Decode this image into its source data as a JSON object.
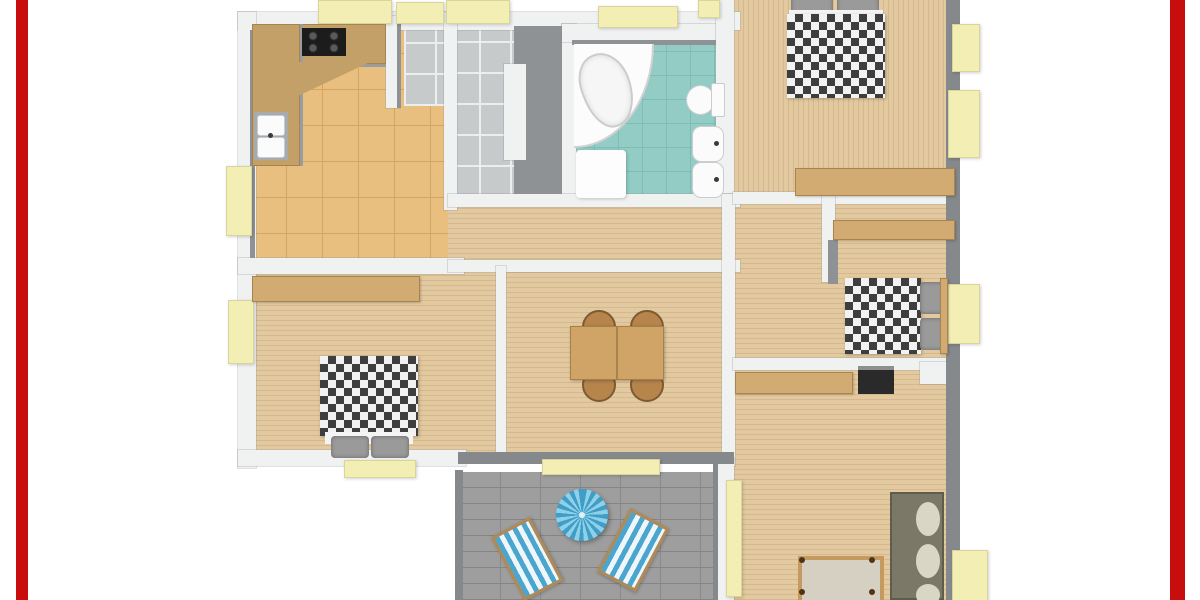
{
  "palette": {
    "page_bg": "#ffffff",
    "frame_red": "#c80d0d",
    "wall_light": "#f0f1f1",
    "wall_mid": "#8f9295",
    "wall_dark": "#85898c",
    "window_sill": "#f3efb4",
    "sill_edge": "#d8d49c",
    "kitchen_tile": "#e8bf7e",
    "kitchen_tile_line": "#d6a65f",
    "counter_wood": "#c4a069",
    "cooktop_black": "#1c1c1c",
    "entry_tile": "#c7cacb",
    "entry_tile_line": "#eceeee",
    "bath_tile": "#92ccc5",
    "bath_tile_line": "#7ebdb6",
    "fixture_white": "#fbfbfb",
    "wood_floor": "#e2c99f",
    "furniture_wood": "#d2ab72",
    "table_wood": "#d0a467",
    "chair_wood": "#b5854b",
    "duvet_dark": "#3e3e3e",
    "duvet_light": "#f2f2f2",
    "pillow_gray": "#9a9a9a",
    "sofa_olive": "#7b7868",
    "cushion_cream": "#d9d6c6",
    "terrace_paver": "#9e9e9e",
    "terrace_line": "#858585",
    "parasol_blue": "#3f9dc6",
    "parasol_blue_light": "#8ed0e8",
    "lounger_blue": "#4aa5cf",
    "lounger_white": "#eef6f9"
  },
  "scene": {
    "type": "3d-floor-plan-top-view",
    "rooms": {
      "kitchen": {
        "name": "kitchen",
        "furniture": [
          "l-shaped-counter",
          "cooktop",
          "double-sink"
        ]
      },
      "entry_hall": {
        "name": "entry hall",
        "furniture": []
      },
      "bathroom": {
        "name": "bathroom",
        "furniture": [
          "corner-bathtub",
          "toilet",
          "sink",
          "bidet",
          "shower-mat"
        ]
      },
      "bedroom_top_right": {
        "name": "bedroom top right",
        "furniture": [
          "double-bed-checkered",
          "sideboard"
        ]
      },
      "hallway": {
        "name": "hallway",
        "furniture": []
      },
      "bedroom_middle_right": {
        "name": "bedroom middle right",
        "furniture": [
          "bed-checkered",
          "wardrobe"
        ]
      },
      "dining_room": {
        "name": "dining room",
        "furniture": [
          "dining-table",
          "four-chairs"
        ]
      },
      "bedroom_left": {
        "name": "bedroom left",
        "furniture": [
          "double-bed-checkered",
          "wardrobe"
        ]
      },
      "living_room": {
        "name": "living room",
        "furniture": [
          "sofa",
          "shelf",
          "tv-unit",
          "bench"
        ]
      },
      "terrace": {
        "name": "terrace",
        "furniture": [
          "parasol",
          "sun-lounger",
          "sun-lounger"
        ]
      }
    }
  }
}
